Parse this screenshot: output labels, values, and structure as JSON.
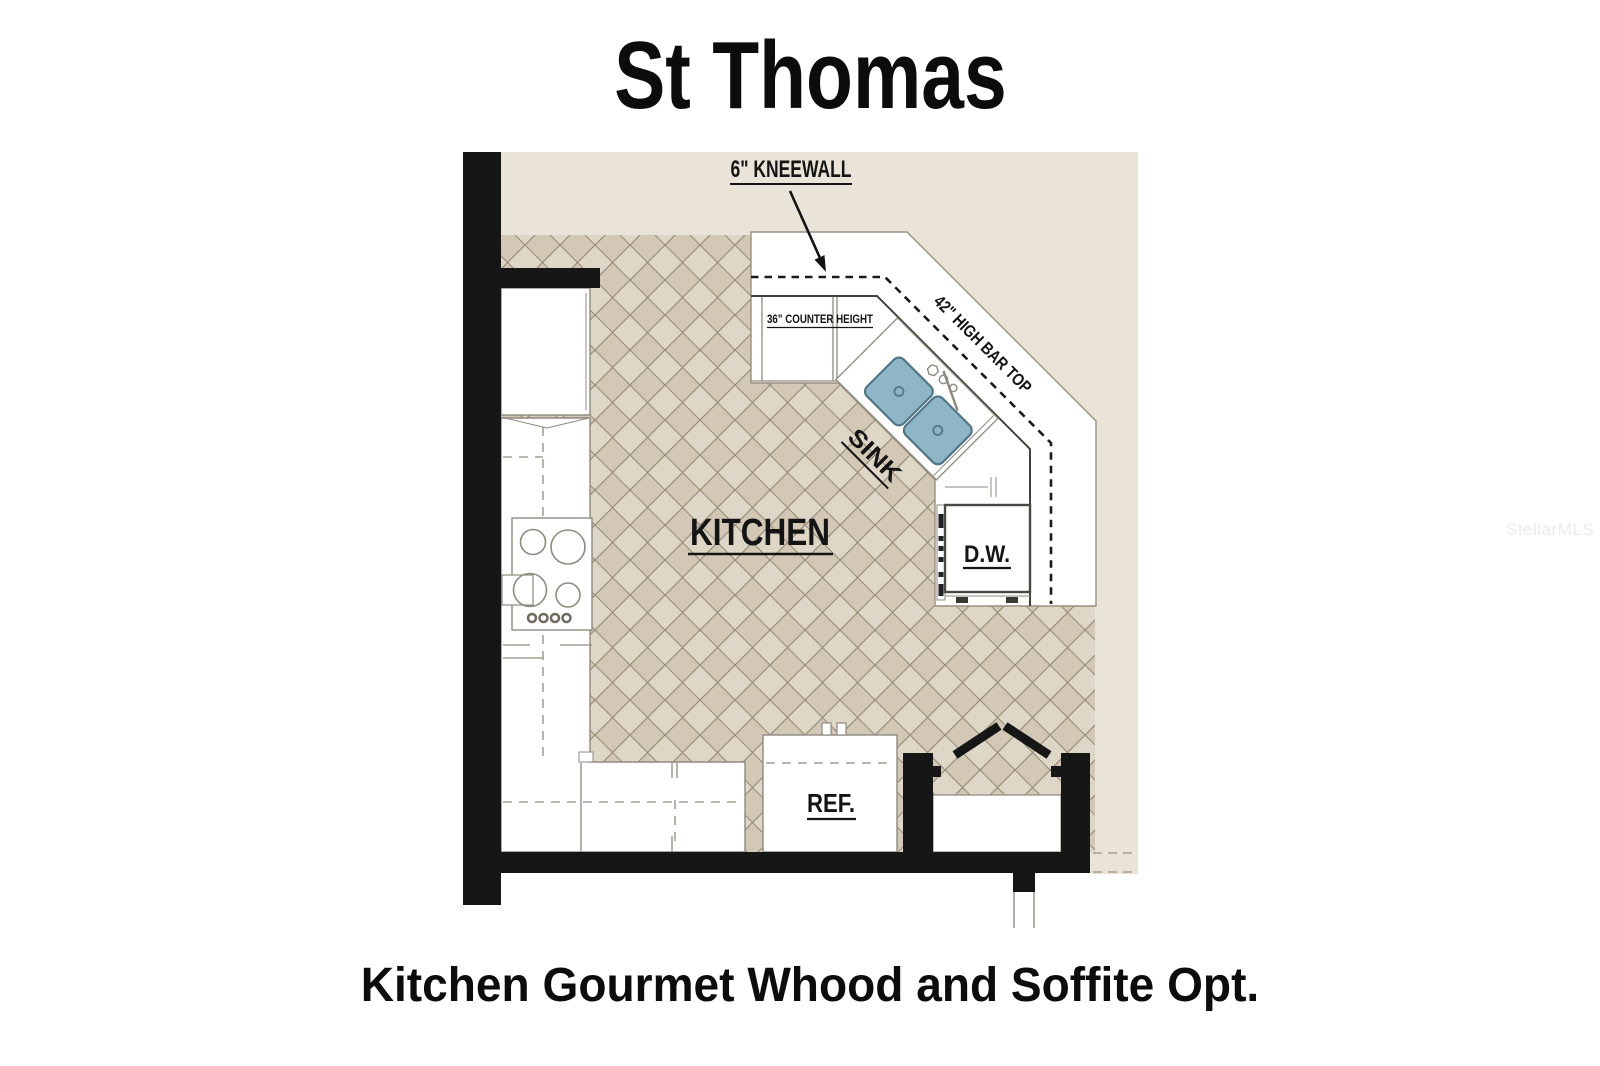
{
  "title": "St Thomas",
  "caption": "Kitchen Gourmet Whood and Soffite Opt.",
  "watermark": "StellarMLS",
  "plan": {
    "room_label": "KITCHEN",
    "labels": {
      "kneewall": "6\" KNEEWALL",
      "counter_height": "36\" COUNTER HEIGHT",
      "bar_top": "42\" HIGH BAR TOP",
      "sink": "SINK",
      "dishwasher": "D.W.",
      "refrigerator": "REF."
    },
    "colors": {
      "background_beige": "#e9e4d7",
      "tile_light": "#ded7c7",
      "tile_dark": "#d2c8b5",
      "grout": "#7e735f",
      "wall": "#161616",
      "surface_white": "#ffffff",
      "sink_fill": "#8fb6c7",
      "sink_border": "#517687",
      "detail_line": "#8f8a80",
      "label_color": "#141414",
      "watermark_color": "#ebebeb"
    }
  }
}
